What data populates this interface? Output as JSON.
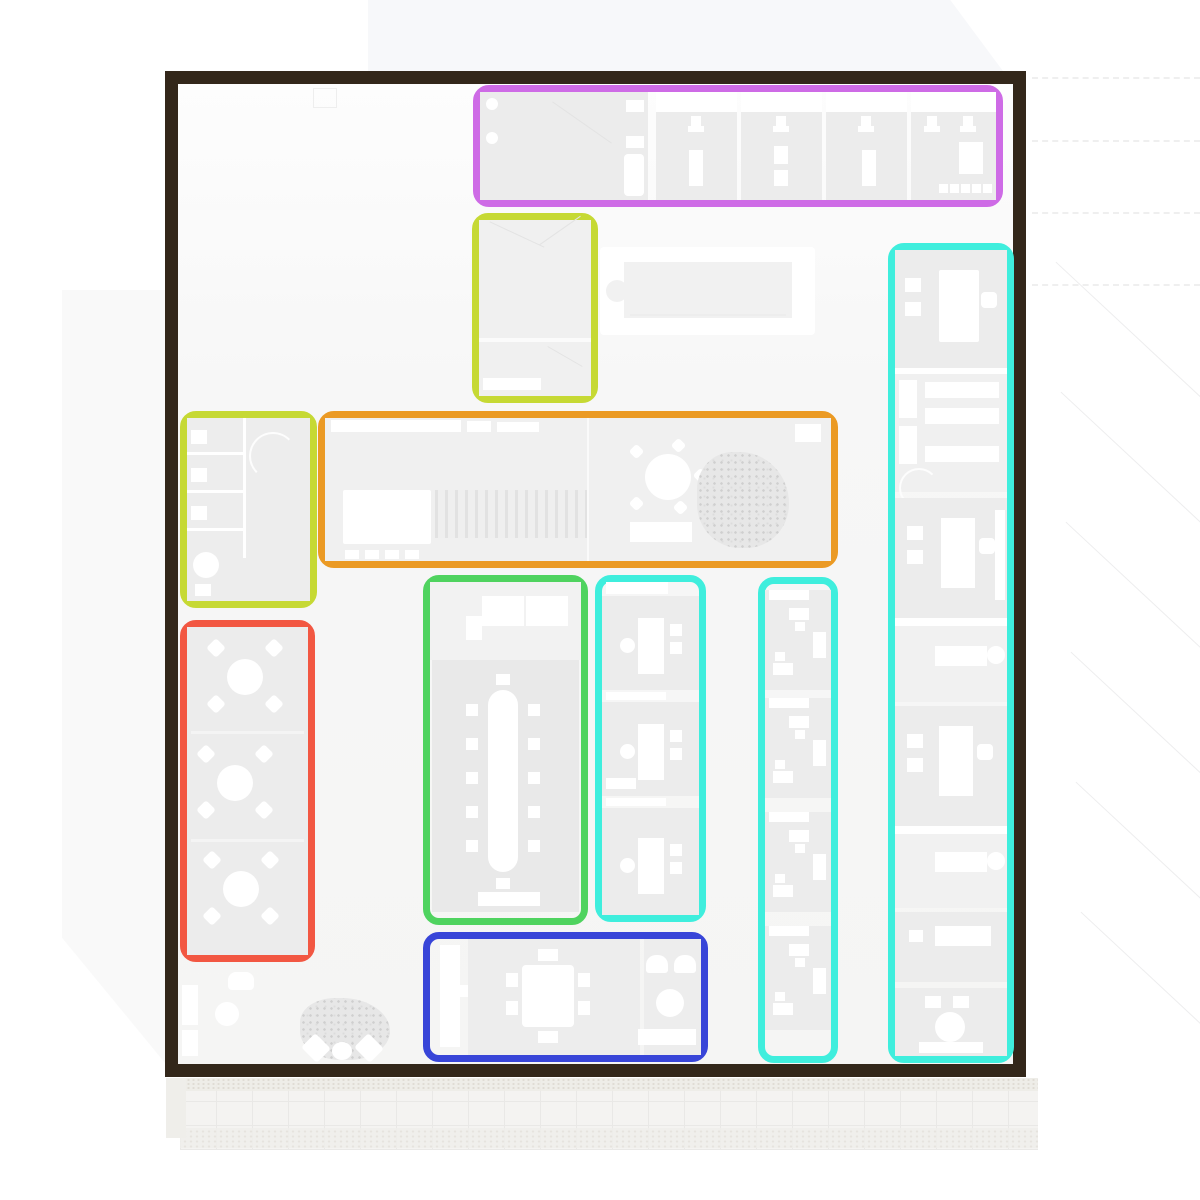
{
  "document": {
    "kind": "architectural floor plan with colored zone annotations",
    "visible_text": "none"
  },
  "palette": {
    "page_bg": "#ffffff",
    "building_outline": "#33271a",
    "floor": "#f7f7f7",
    "room_fill": "#ececec",
    "furniture": "#ffffff",
    "terrace_grid": "#e9e8e6"
  },
  "building": {
    "rect": [
      165,
      71,
      861,
      1006
    ],
    "stroke_px": 13,
    "outline_color": "#33271a"
  },
  "zones": [
    {
      "id": "offices-top",
      "name": "top office row",
      "color": "#ce6be6",
      "rect": [
        473,
        85,
        530,
        122
      ]
    },
    {
      "id": "stair-room",
      "name": "upper small room",
      "color": "#c6d934",
      "rect": [
        472,
        213,
        126,
        190
      ]
    },
    {
      "id": "wc-left",
      "name": "left washroom block",
      "color": "#c6d934",
      "rect": [
        180,
        411,
        137,
        197
      ]
    },
    {
      "id": "canteen",
      "name": "central hall with round table",
      "color": "#eb9a24",
      "rect": [
        318,
        411,
        520,
        157
      ]
    },
    {
      "id": "break-tables",
      "name": "left column of round tables",
      "color": "#f25742",
      "rect": [
        180,
        620,
        135,
        342
      ]
    },
    {
      "id": "conference",
      "name": "conference room",
      "color": "#4fd35f",
      "rect": [
        423,
        575,
        165,
        350
      ]
    },
    {
      "id": "workstations-mid",
      "name": "middle workstation column",
      "color": "#3feedd",
      "rect": [
        595,
        575,
        111,
        347
      ]
    },
    {
      "id": "offices-strip",
      "name": "narrow office strip",
      "color": "#3feedd",
      "rect": [
        758,
        577,
        80,
        486
      ]
    },
    {
      "id": "offices-right",
      "name": "far right office column",
      "color": "#3feedd",
      "rect": [
        888,
        243,
        126,
        820
      ]
    },
    {
      "id": "lounge-dining",
      "name": "bottom dining and lounge",
      "color": "#3845d8",
      "rect": [
        423,
        932,
        285,
        130
      ]
    }
  ]
}
